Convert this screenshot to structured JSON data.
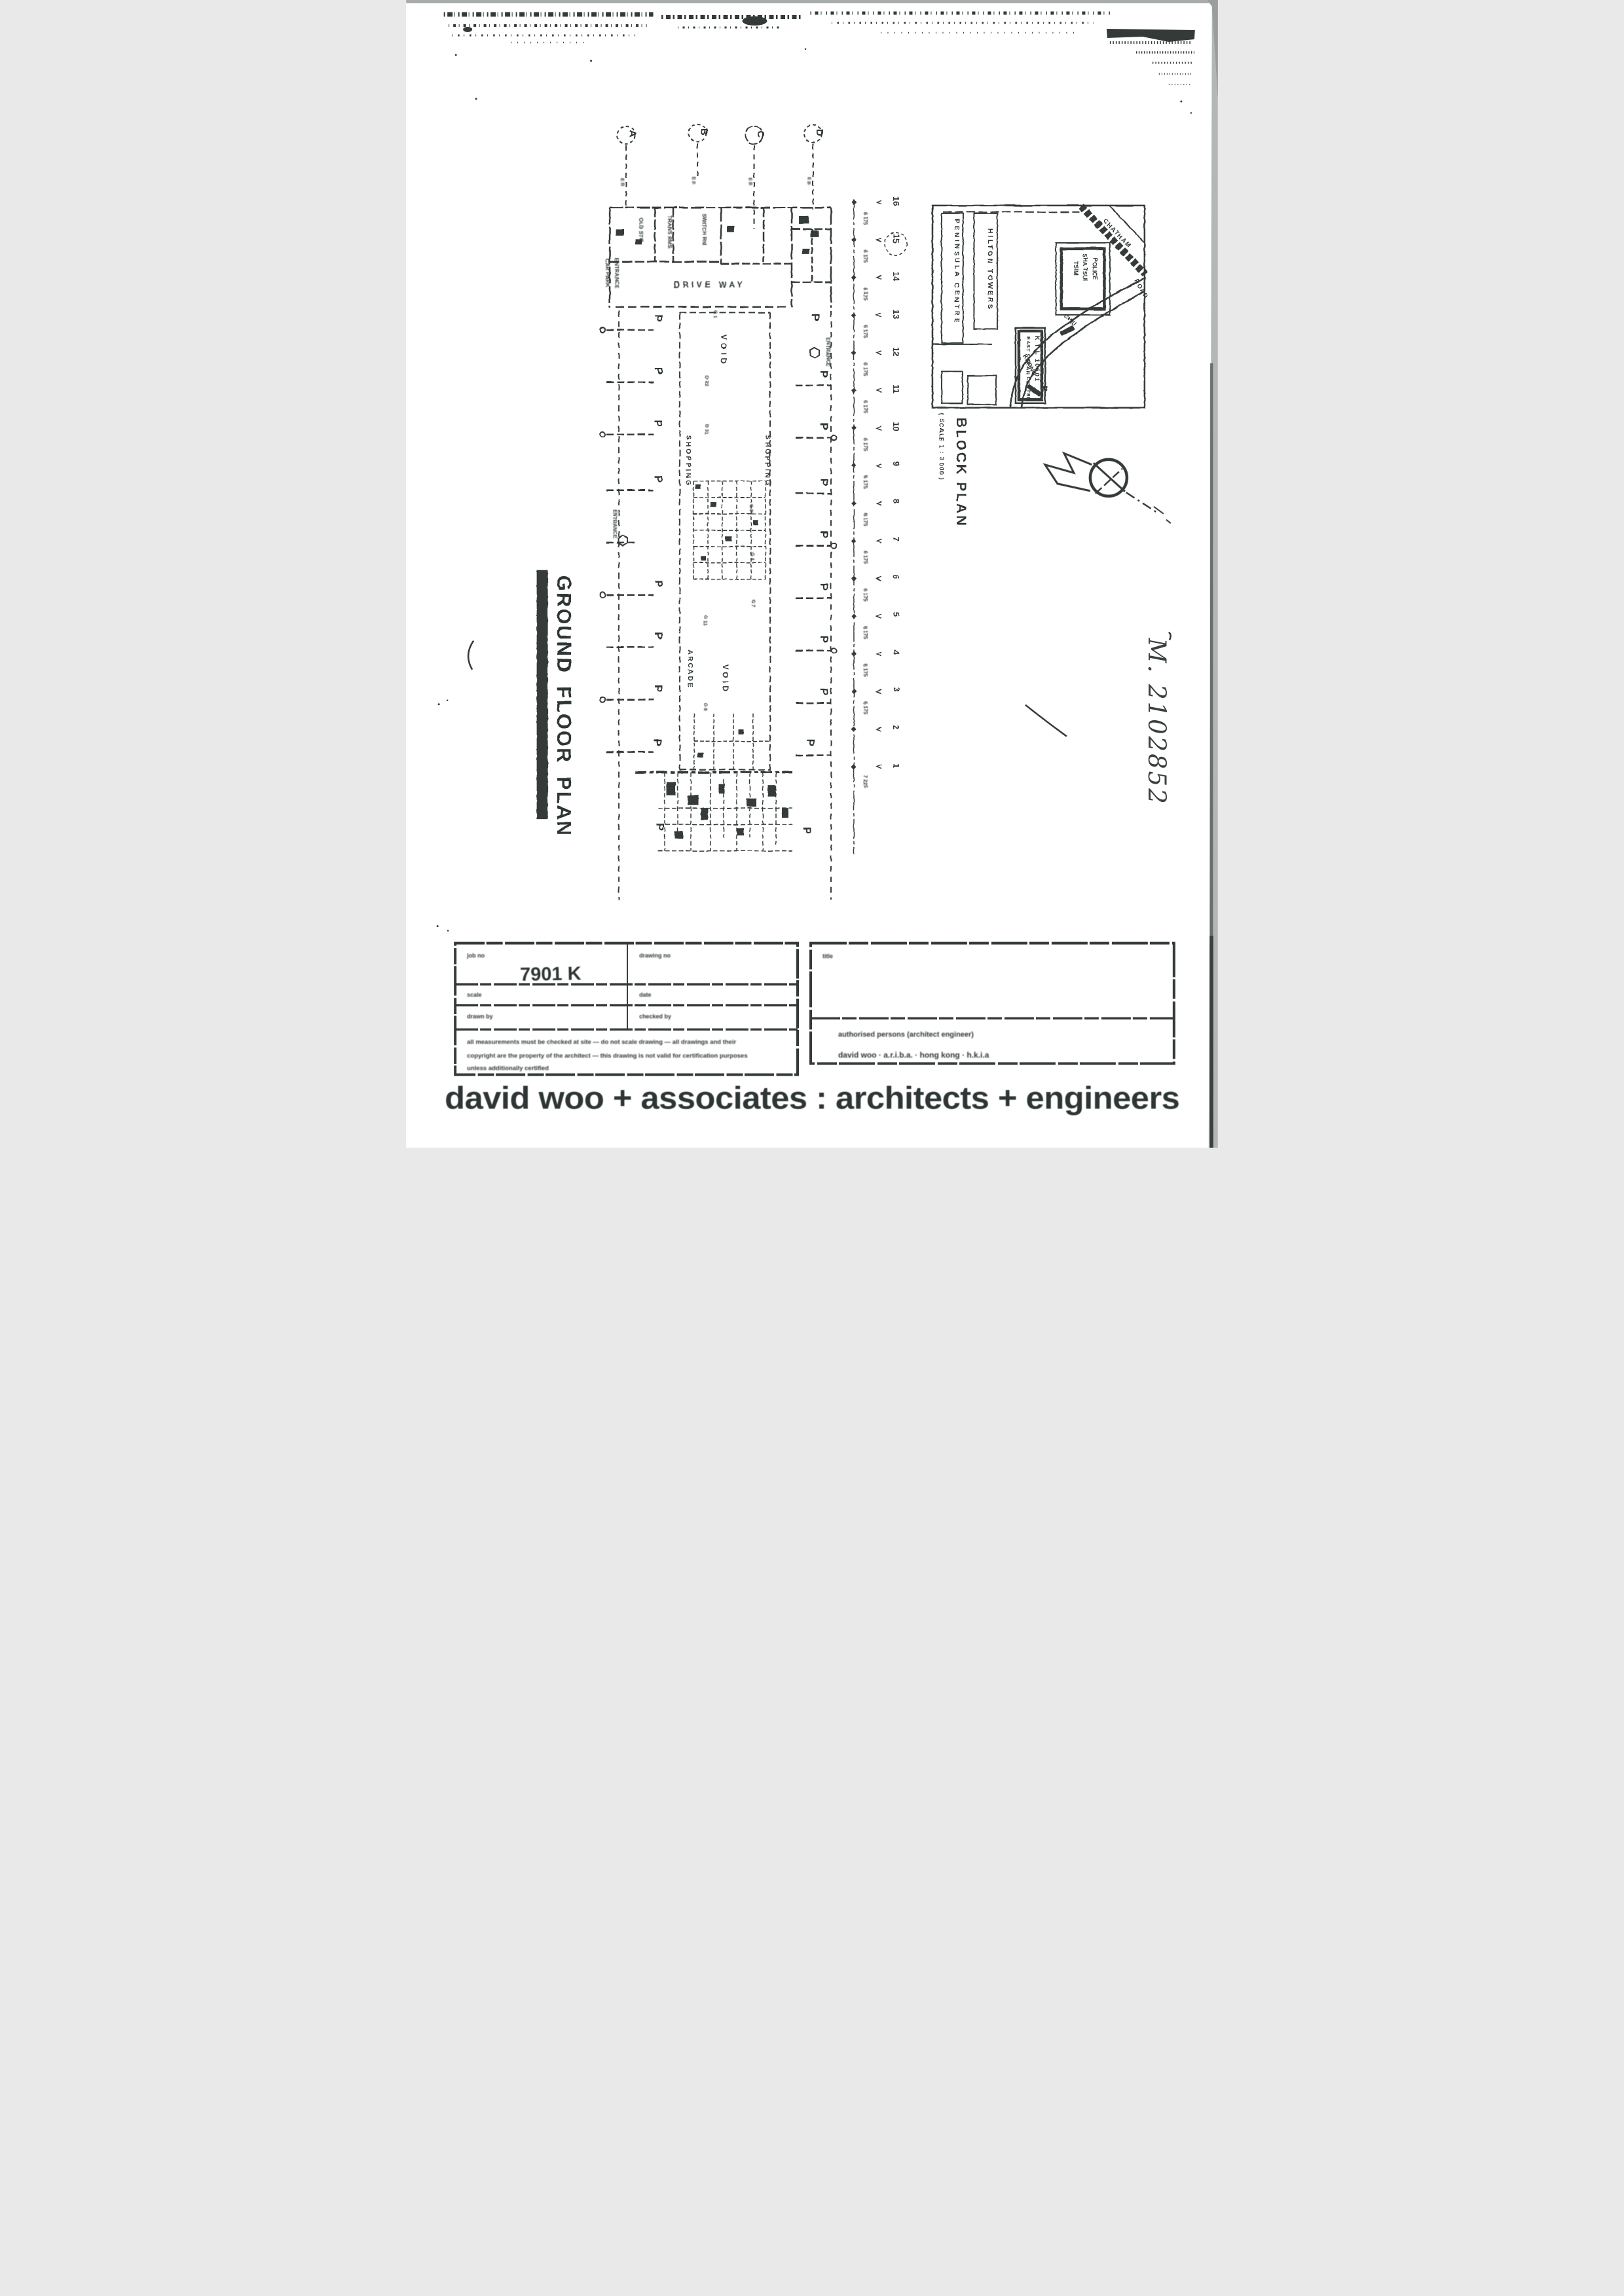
{
  "colors": {
    "ink": "#343a38",
    "paper": "#ffffff",
    "scan_edge": "#b3b7b6"
  },
  "plan": {
    "title": "GROUND FLOOR PLAN",
    "grid_letters": [
      "A",
      "B",
      "C",
      "D"
    ],
    "grid_numbers": [
      "16",
      "15",
      "14",
      "13",
      "12",
      "11",
      "10",
      "9",
      "8",
      "7",
      "6",
      "5",
      "4",
      "3",
      "2",
      "1"
    ],
    "dims": [
      "6 175",
      "6 175",
      "6 175",
      "6 175",
      "6 175",
      "6 175",
      "6 175",
      "6 175",
      "6 175",
      "6 175",
      "6 175",
      "6 175",
      "6 175",
      "6 175",
      "7 225"
    ],
    "labels": {
      "car_park_1": "CAR PARK",
      "car_park_2": "ENTRANCE",
      "drive_way": "DRIVE WAY",
      "old_sto": "OLD STO",
      "trans": "TRANS RMS",
      "switch": "SWITCH RM",
      "void": "VOID",
      "shopping": "SHOPPING",
      "arcade": "ARCADE",
      "entrance": "ENTRANCE",
      "p": "P",
      "marker_sub": "E B"
    },
    "stall_codes": [
      "G 1",
      "D 22",
      "D 31",
      "G 87",
      "G 4",
      "G 7",
      "G 11",
      "G 8"
    ]
  },
  "block_plan": {
    "caption": "BLOCK PLAN",
    "scale": "( SCALE 1 : 3 000 )",
    "labels": {
      "peninsula": "PENINSULA CENTRE",
      "hilton": "HILTON TOWERS",
      "police_1": "TSIM",
      "police_2": "SHA TSUI",
      "police_3": "POLICE",
      "site_lot": "K I L 10601",
      "site_name": "EAST OCEAN CENTRE",
      "site_p": "P",
      "chatham": "CHATHAM",
      "road": "ROAD",
      "kwong": "KWONG",
      "chiu": "CHIU"
    }
  },
  "annotations": {
    "handwriting": "M. 2102852"
  },
  "title_block": {
    "job_no_label": "job no",
    "job_no": "7901 K",
    "drawing_no_label": "drawing no",
    "scale_label": "scale",
    "date_label": "date",
    "drawn_by_label": "drawn by",
    "checked_by_label": "checked by",
    "title_label": "title",
    "disclaimer_1": "all measurements must be checked at site — do not scale drawing — all drawings and their",
    "disclaimer_2": "copyright are the property of the architect — this drawing is not valid for certification purposes",
    "disclaimer_3": "unless additionally certified",
    "credit_1": "authorised persons (architect engineer)",
    "credit_2": "david woo · a.r.i.b.a. · hong kong · h.k.i.a"
  },
  "footer": {
    "firm": "david woo + associates : architects + engineers"
  }
}
